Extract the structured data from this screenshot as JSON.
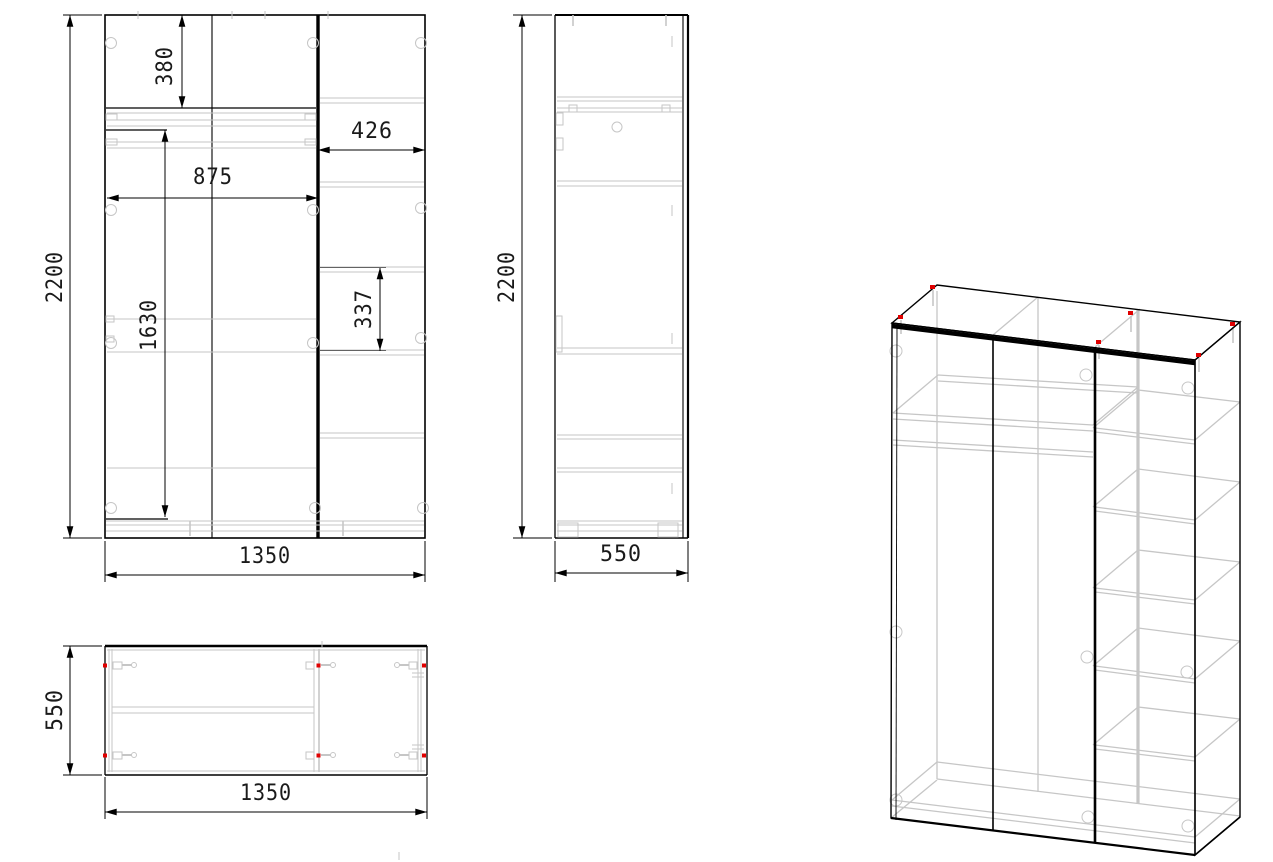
{
  "drawing": {
    "front_view": {
      "dim_height": "2200",
      "dim_top_shelf_drop": "380",
      "dim_left_section_width": "875",
      "dim_right_section_width": "426",
      "dim_rail_height": "1630",
      "dim_shelf_spacing": "337",
      "dim_width": "1350"
    },
    "side_view": {
      "dim_height": "2200",
      "dim_depth": "550"
    },
    "top_view": {
      "dim_depth": "550",
      "dim_width": "1350"
    },
    "colors": {
      "outline": "#000000",
      "secondary": "#c6c6c6",
      "marker": "#e00000",
      "text": "#1a1a1a",
      "background": "#ffffff"
    }
  }
}
